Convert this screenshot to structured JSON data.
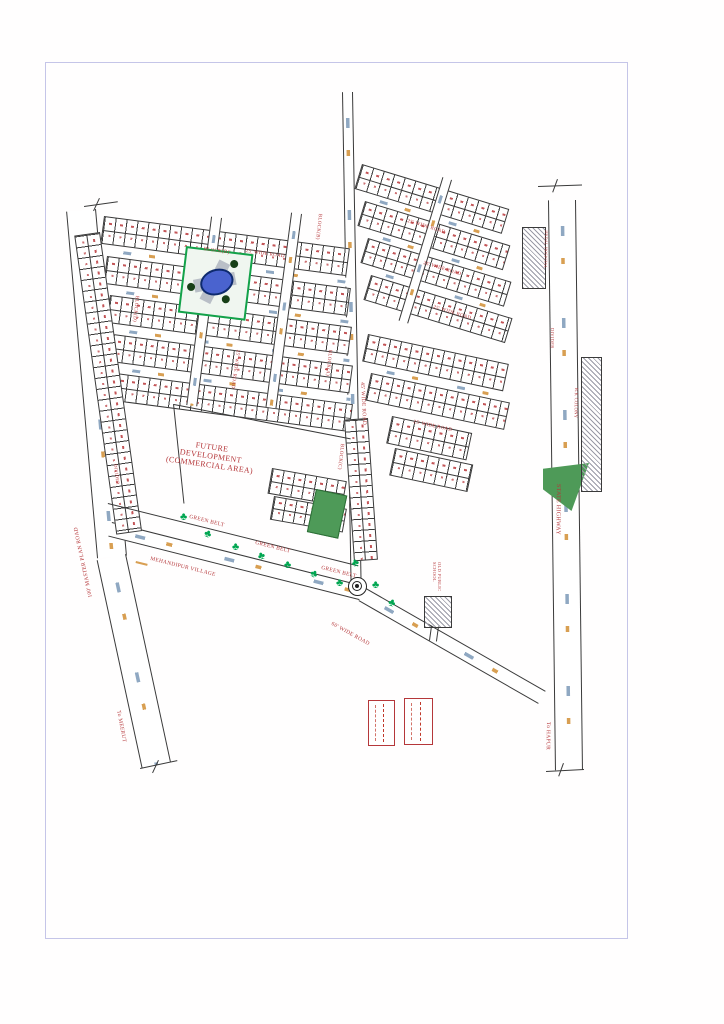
{
  "drawing": {
    "areas": {
      "future_development": {
        "line1": "FUTURE",
        "line2": "DEVELOPMENT",
        "line3": "(COMMERCIAL AREA)"
      },
      "green_belt": "GREEN BELT",
      "village": "MEHANDIPUR VILLAGE",
      "school": "OLD PUBLIC SCHOOL",
      "hospital": "JINDAL HOSPITAL",
      "colony": "R.K COLONY"
    },
    "roads": {
      "master": "100' MASTER PLAN ROAD",
      "highway": "STATE HIGHWAY",
      "divider": "DIVIDER",
      "r25": "25' WIDE ROAD",
      "r45": "45' WIDE ROAD",
      "r60": "60' WIDE ROAD"
    },
    "destinations": {
      "meerut": "To MEERUT",
      "hapur": "To HAPUR"
    },
    "blocks": {
      "a": "BLOCK(A)",
      "b": "BLOCK(B)",
      "c": "BLOCK(C)",
      "d": "BLOCK(D)"
    },
    "icons": {
      "tree": "♣"
    },
    "colors": {
      "label_red": "#b5373a",
      "tree_green": "#00a651",
      "belt_green": "#4e9a58",
      "pond_blue": "#4a63cf",
      "dash_orange": "#d89f52",
      "dash_blue": "#8fa8c2",
      "frame": "#c5c5e8",
      "line": "#3a3a3a"
    }
  }
}
